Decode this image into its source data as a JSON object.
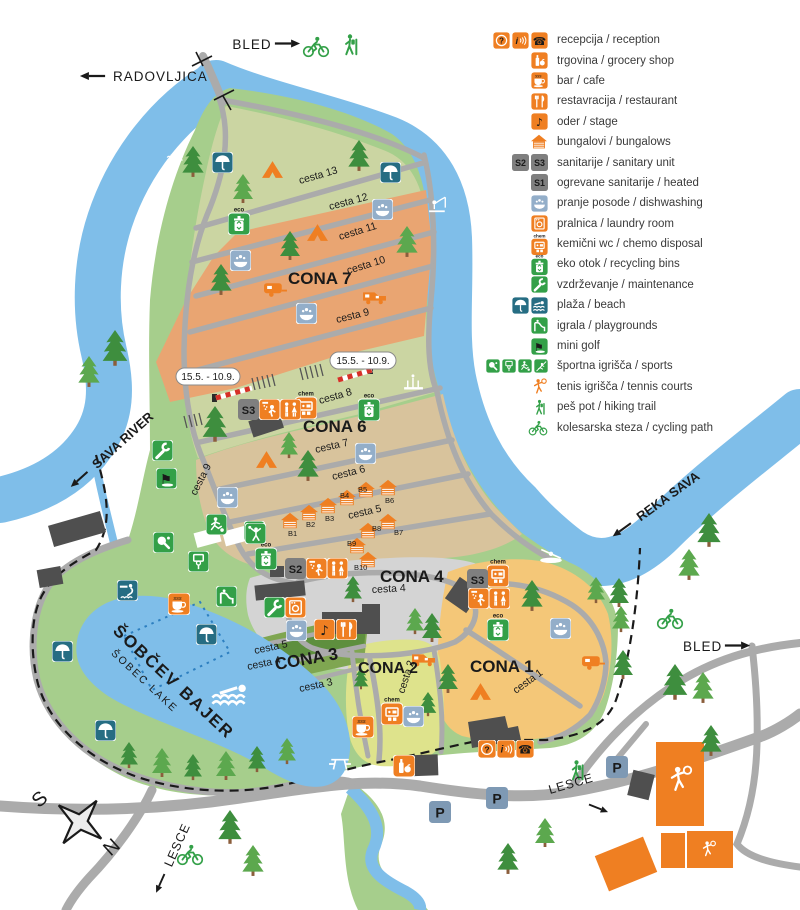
{
  "colors": {
    "orange": "#EF7F22",
    "zone7_orange": "#E9A572",
    "zone1_yellow": "#F4C778",
    "zone2_yellowgreen": "#DEE38C",
    "zone3_green": "#7FA651",
    "zone3_dark_green": "#5E8F3E",
    "zone4_gray": "#D4D4D4",
    "zone6_tan": "#D8C39C",
    "rows_olive": "#CBD5A2",
    "camp_green": "#A6CE8C",
    "river_blue": "#7FBEE9",
    "road_gray": "#ABABAB",
    "building_gray": "#4F4F4F",
    "teal_icon": "#266D83",
    "dishwashing_blue": "#93AEC9",
    "icon_green": "#33A048",
    "badge_gray": "#7F7F7F",
    "parking_blue": "#7E99B4"
  },
  "legend": {
    "items": [
      {
        "id": "reception",
        "label": "recepcija / reception"
      },
      {
        "id": "grocery",
        "label": "trgovina / grocery shop"
      },
      {
        "id": "bar",
        "label": "bar / cafe"
      },
      {
        "id": "restaurant",
        "label": "restavracija / restaurant"
      },
      {
        "id": "stage",
        "label": "oder / stage"
      },
      {
        "id": "bungalows",
        "label": "bungalovi / bungalows"
      },
      {
        "id": "sanitary",
        "label": "sanitarije / sanitary unit"
      },
      {
        "id": "heated-sanitary",
        "label": "ogrevane sanitarije / heated"
      },
      {
        "id": "dishwashing",
        "label": "pranje posode / dishwashing"
      },
      {
        "id": "laundry",
        "label": "pralnica / laundry room"
      },
      {
        "id": "chemo-disposal",
        "label": "kemični wc / chemo disposal"
      },
      {
        "id": "recycling",
        "label": "eko otok / recycling bins"
      },
      {
        "id": "maintenance",
        "label": "vzdrževanje / maintenance"
      },
      {
        "id": "beach",
        "label": "plaža / beach"
      },
      {
        "id": "playgrounds",
        "label": "igrala / playgrounds"
      },
      {
        "id": "minigolf",
        "label": "mini golf"
      },
      {
        "id": "sports",
        "label": "športna igrišča / sports"
      },
      {
        "id": "tennis",
        "label": "tenis igrišča / tennis courts"
      },
      {
        "id": "hiking",
        "label": "peš pot / hiking trail"
      },
      {
        "id": "cycling",
        "label": "kolesarska steza / cycling path"
      }
    ]
  },
  "map": {
    "zones": {
      "cona1": "CONA 1",
      "cona2": "CONA 2",
      "cona3": "CONA 3",
      "cona4": "CONA 4",
      "cona6": "CONA 6",
      "cona7": "CONA 7"
    },
    "roads": {
      "c1": "cesta 1",
      "c2": "cesta 2",
      "c3": "cesta 3",
      "c4": "cesta 4",
      "c5": "cesta 5",
      "c6": "cesta 6",
      "c7": "cesta 7",
      "c8": "cesta 8",
      "c9": "cesta 9",
      "c10": "cesta 10",
      "c11": "cesta 11",
      "c12": "cesta 12",
      "c13": "cesta 13"
    },
    "rivers": {
      "sava": "SAVA RIVER",
      "reka": "REKA SAVA"
    },
    "lake": {
      "local": "ŠOBČEV BAJER",
      "english": "ŠOBEC LAKE"
    },
    "directions": {
      "bled": "BLED",
      "radovljica": "RADOVLJICA",
      "lesce": "LESCE"
    },
    "compass": {
      "south": "S",
      "north": "N"
    },
    "badges": {
      "s1": "S1",
      "s2": "S2",
      "s3": "S3",
      "parking": "P",
      "eco": "eco",
      "chem": "chem",
      "steam": "sss"
    },
    "season": "15.5. - 10.9.",
    "bungalows": [
      "B1",
      "B2",
      "B3",
      "B4",
      "B5",
      "B6",
      "B7",
      "B8",
      "B9",
      "B10"
    ]
  }
}
